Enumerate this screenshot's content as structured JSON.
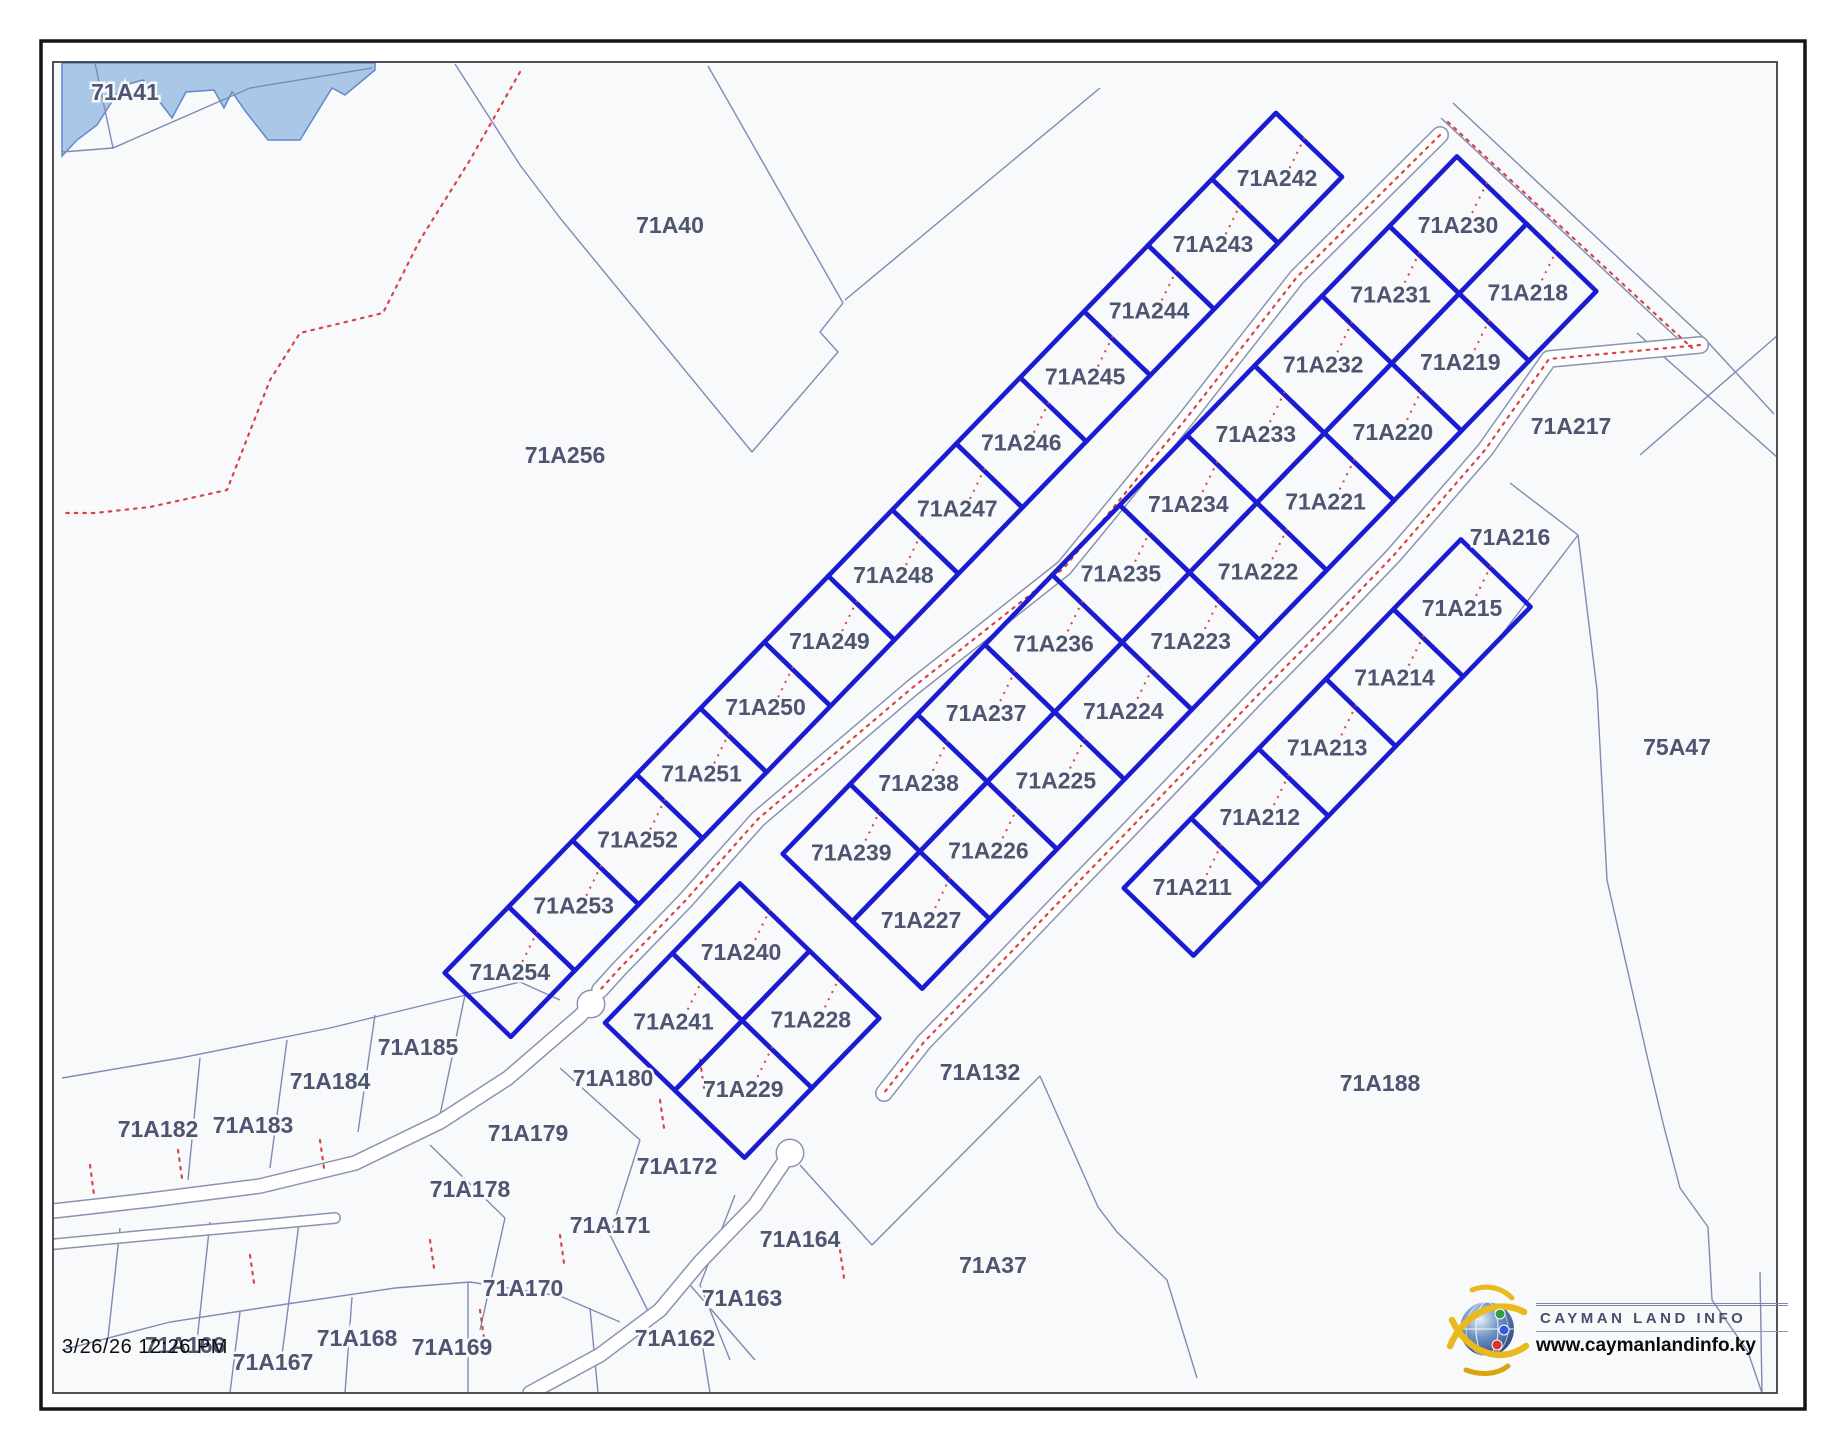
{
  "timestamp": "3/26/26 12:26 PM",
  "logo": {
    "brand": "CAYMAN LAND INFO",
    "url": "www.caymanlandinfo.ky"
  },
  "map": {
    "width": 1843,
    "height": 1445,
    "inner_frame": [
      53,
      62,
      1724,
      1331
    ],
    "outer_frame": [
      41,
      41,
      1764,
      1368
    ],
    "colors": {
      "bg": "#f8f9fb",
      "blue": "#1b1bd0",
      "thin": "#7f8ab5",
      "red": "#d94545",
      "water_fill": "#aac7e8",
      "water_line": "#6089cc",
      "label": "#4d5570",
      "road_casing": "#8a93b0",
      "frame_outer": "#141414",
      "frame_inner": "#3f3f44"
    },
    "u": [
      -0.695,
      0.719
    ],
    "v": [
      0.719,
      0.695
    ],
    "water": [
      [
        62,
        63
      ],
      [
        375,
        63
      ],
      [
        375,
        70
      ],
      [
        345,
        95
      ],
      [
        332,
        88
      ],
      [
        300,
        140
      ],
      [
        268,
        140
      ],
      [
        246,
        112
      ],
      [
        232,
        92
      ],
      [
        224,
        108
      ],
      [
        214,
        90
      ],
      [
        186,
        92
      ],
      [
        172,
        118
      ],
      [
        143,
        80
      ],
      [
        122,
        86
      ],
      [
        97,
        125
      ],
      [
        77,
        140
      ],
      [
        62,
        156
      ]
    ],
    "strips": [
      {
        "name": "west-strip",
        "start": [
          1277,
          178
        ],
        "step": 92,
        "hu": 46,
        "hv": 46,
        "cols": [
          [
            "71A242",
            "71A243",
            "71A244",
            "71A245",
            "71A246",
            "71A247",
            "71A248",
            "71A249",
            "71A250",
            "71A251",
            "71A252",
            "71A253",
            "71A254"
          ]
        ]
      },
      {
        "name": "main-block",
        "start": [
          1458,
          225
        ],
        "step": 97,
        "hu": 48.5,
        "hv": 48.5,
        "cols": [
          [
            "71A230",
            "71A231",
            "71A232",
            "71A233",
            "71A234",
            "71A235",
            "71A236",
            "71A237",
            "71A238",
            "71A239"
          ],
          [
            "71A218",
            "71A219",
            "71A220",
            "71A221",
            "71A222",
            "71A223",
            "71A224",
            "71A225",
            "71A226",
            "71A227"
          ]
        ]
      },
      {
        "name": "bottom-block",
        "start": [
          741,
          952
        ],
        "step": 97,
        "hu": 48.5,
        "hv": 48.5,
        "cols": [
          [
            "71A240",
            "71A241"
          ],
          [
            "71A228",
            "71A229"
          ]
        ]
      },
      {
        "name": "south-strip",
        "start": [
          1462,
          608
        ],
        "step": 97,
        "hu": 48.5,
        "hv": 48.5,
        "cols": [
          [
            "71A215",
            "71A214",
            "71A213",
            "71A212",
            "71A211"
          ]
        ]
      }
    ],
    "standalone_labels": [
      {
        "t": "71A41",
        "x": 125,
        "y": 92
      },
      {
        "t": "71A40",
        "x": 670,
        "y": 225
      },
      {
        "t": "71A256",
        "x": 565,
        "y": 455
      },
      {
        "t": "71A217",
        "x": 1571,
        "y": 426
      },
      {
        "t": "71A216",
        "x": 1510,
        "y": 537
      },
      {
        "t": "75A47",
        "x": 1677,
        "y": 747
      },
      {
        "t": "71A188",
        "x": 1380,
        "y": 1083
      },
      {
        "t": "71A132",
        "x": 980,
        "y": 1072
      },
      {
        "t": "71A37",
        "x": 993,
        "y": 1265
      },
      {
        "t": "71A185",
        "x": 418,
        "y": 1047
      },
      {
        "t": "71A184",
        "x": 330,
        "y": 1081
      },
      {
        "t": "71A183",
        "x": 253,
        "y": 1125
      },
      {
        "t": "71A182",
        "x": 158,
        "y": 1129
      },
      {
        "t": "71A180",
        "x": 613,
        "y": 1078
      },
      {
        "t": "71A179",
        "x": 528,
        "y": 1133
      },
      {
        "t": "71A178",
        "x": 470,
        "y": 1189
      },
      {
        "t": "71A172",
        "x": 677,
        "y": 1166
      },
      {
        "t": "71A171",
        "x": 610,
        "y": 1225
      },
      {
        "t": "71A170",
        "x": 523,
        "y": 1288
      },
      {
        "t": "71A164",
        "x": 800,
        "y": 1239
      },
      {
        "t": "71A163",
        "x": 742,
        "y": 1298
      },
      {
        "t": "71A162",
        "x": 675,
        "y": 1338
      },
      {
        "t": "71A166",
        "x": 185,
        "y": 1345
      },
      {
        "t": "71A167",
        "x": 273,
        "y": 1362
      },
      {
        "t": "71A168",
        "x": 357,
        "y": 1338
      },
      {
        "t": "71A169",
        "x": 452,
        "y": 1347
      }
    ],
    "thin_lines": [
      [
        [
          95,
          63
        ],
        [
          113,
          148
        ]
      ],
      [
        [
          62,
          152
        ],
        [
          113,
          148
        ],
        [
          250,
          88
        ],
        [
          372,
          68
        ]
      ],
      [
        [
          455,
          64
        ],
        [
          520,
          165
        ],
        [
          560,
          218
        ],
        [
          752,
          452
        ]
      ],
      [
        [
          708,
          66
        ],
        [
          843,
          303
        ]
      ],
      [
        [
          843,
          303
        ],
        [
          820,
          332
        ],
        [
          838,
          352
        ],
        [
          752,
          452
        ]
      ],
      [
        [
          845,
          300
        ],
        [
          1100,
          88
        ]
      ],
      [
        [
          1453,
          103
        ],
        [
          1705,
          339
        ],
        [
          1774,
          414
        ]
      ],
      [
        [
          1441,
          118
        ],
        [
          1692,
          352
        ]
      ],
      [
        [
          1640,
          455
        ],
        [
          1778,
          335
        ]
      ],
      [
        [
          1637,
          333
        ],
        [
          1778,
          458
        ]
      ],
      [
        [
          1510,
          483
        ],
        [
          1578,
          535
        ]
      ],
      [
        [
          1490,
          650
        ],
        [
          1578,
          535
        ]
      ],
      [
        [
          1578,
          535
        ],
        [
          1597,
          690
        ],
        [
          1607,
          880
        ],
        [
          1648,
          1060
        ],
        [
          1663,
          1123
        ],
        [
          1680,
          1188
        ],
        [
          1708,
          1227
        ],
        [
          1712,
          1300
        ],
        [
          1748,
          1352
        ],
        [
          1762,
          1393
        ]
      ],
      [
        [
          800,
          1165
        ],
        [
          872,
          1245
        ],
        [
          1040,
          1076
        ]
      ],
      [
        [
          1040,
          1076
        ],
        [
          1098,
          1207
        ],
        [
          1117,
          1232
        ],
        [
          1167,
          1280
        ],
        [
          1197,
          1378
        ]
      ],
      [
        [
          62,
          1078
        ],
        [
          180,
          1058
        ],
        [
          330,
          1028
        ],
        [
          445,
          1000
        ],
        [
          520,
          982
        ],
        [
          560,
          1000
        ]
      ],
      [
        [
          200,
          1058
        ],
        [
          188,
          1180
        ]
      ],
      [
        [
          287,
          1040
        ],
        [
          270,
          1168
        ]
      ],
      [
        [
          375,
          1015
        ],
        [
          358,
          1132
        ]
      ],
      [
        [
          465,
          995
        ],
        [
          440,
          1115
        ]
      ],
      [
        [
          120,
          1228
        ],
        [
          108,
          1338
        ]
      ],
      [
        [
          210,
          1222
        ],
        [
          196,
          1350
        ]
      ],
      [
        [
          300,
          1215
        ],
        [
          282,
          1355
        ]
      ],
      [
        [
          430,
          1145
        ],
        [
          505,
          1218
        ]
      ],
      [
        [
          505,
          1218
        ],
        [
          480,
          1330
        ]
      ],
      [
        [
          560,
          1068
        ],
        [
          640,
          1140
        ]
      ],
      [
        [
          640,
          1140
        ],
        [
          610,
          1235
        ],
        [
          650,
          1315
        ]
      ],
      [
        [
          735,
          1195
        ],
        [
          700,
          1285
        ],
        [
          730,
          1360
        ]
      ],
      [
        [
          62,
          1350
        ],
        [
          170,
          1322
        ],
        [
          280,
          1305
        ],
        [
          395,
          1288
        ],
        [
          470,
          1282
        ],
        [
          560,
          1296
        ],
        [
          620,
          1322
        ]
      ],
      [
        [
          240,
          1312
        ],
        [
          230,
          1393
        ]
      ],
      [
        [
          352,
          1297
        ],
        [
          345,
          1393
        ]
      ],
      [
        [
          468,
          1283
        ],
        [
          468,
          1393
        ]
      ],
      [
        [
          590,
          1308
        ],
        [
          598,
          1393
        ]
      ],
      [
        [
          700,
          1330
        ],
        [
          710,
          1393
        ]
      ],
      [
        [
          690,
          1285
        ],
        [
          755,
          1360
        ]
      ],
      [
        [
          1760,
          1272
        ],
        [
          1762,
          1393
        ]
      ]
    ],
    "roads": [
      {
        "name": "subdivision-road-a",
        "w": 15,
        "pts": [
          [
            1440,
            135
          ],
          [
            1297,
            277
          ],
          [
            1185,
            420
          ],
          [
            1064,
            568
          ],
          [
            912,
            688
          ],
          [
            758,
            819
          ],
          [
            685,
            901
          ],
          [
            620,
            968
          ],
          [
            600,
            990
          ]
        ]
      },
      {
        "name": "subdivision-road-b",
        "w": 15,
        "pts": [
          [
            1700,
            345
          ],
          [
            1549,
            359
          ],
          [
            1485,
            450
          ],
          [
            1394,
            555
          ],
          [
            1327,
            625
          ],
          [
            1259,
            694
          ],
          [
            1192,
            764
          ],
          [
            1125,
            834
          ],
          [
            1058,
            903
          ],
          [
            991,
            973
          ],
          [
            924,
            1042
          ],
          [
            884,
            1093
          ]
        ]
      },
      {
        "name": "west-access-road",
        "w": 13,
        "pts": [
          [
            45,
            1212
          ],
          [
            150,
            1200
          ],
          [
            260,
            1186
          ],
          [
            355,
            1163
          ],
          [
            440,
            1122
          ],
          [
            508,
            1078
          ],
          [
            552,
            1040
          ],
          [
            580,
            1016
          ],
          [
            591,
            1004
          ]
        ]
      },
      {
        "name": "west-access-road-2",
        "w": 9,
        "pts": [
          [
            45,
            1245
          ],
          [
            150,
            1235
          ],
          [
            250,
            1226
          ],
          [
            335,
            1218
          ]
        ]
      },
      {
        "name": "south-road",
        "w": 13,
        "pts": [
          [
            790,
            1153
          ],
          [
            755,
            1205
          ],
          [
            700,
            1262
          ],
          [
            660,
            1310
          ],
          [
            600,
            1355
          ],
          [
            530,
            1393
          ]
        ]
      }
    ],
    "culdesacs": [
      {
        "c": [
          591,
          1004
        ],
        "r": 13
      },
      {
        "c": [
          790,
          1153
        ],
        "r": 13
      }
    ],
    "red_dotted": [
      [
        [
          1440,
          135
        ],
        [
          1297,
          277
        ],
        [
          1185,
          420
        ],
        [
          1064,
          568
        ],
        [
          912,
          688
        ],
        [
          758,
          819
        ],
        [
          685,
          901
        ],
        [
          620,
          968
        ],
        [
          600,
          990
        ]
      ],
      [
        [
          1700,
          345
        ],
        [
          1549,
          359
        ],
        [
          1485,
          450
        ],
        [
          1394,
          555
        ],
        [
          1327,
          625
        ],
        [
          1259,
          694
        ],
        [
          1192,
          764
        ],
        [
          1125,
          834
        ],
        [
          1058,
          903
        ],
        [
          991,
          973
        ],
        [
          924,
          1042
        ],
        [
          884,
          1093
        ]
      ],
      [
        [
          1448,
          122
        ],
        [
          1692,
          348
        ]
      ],
      [
        [
          520,
          72
        ],
        [
          470,
          160
        ],
        [
          420,
          240
        ],
        [
          383,
          313
        ],
        [
          300,
          333
        ],
        [
          270,
          380
        ],
        [
          227,
          490
        ],
        [
          150,
          507
        ],
        [
          95,
          513
        ],
        [
          64,
          513
        ]
      ],
      [
        [
          90,
          1165
        ],
        [
          94,
          1195
        ]
      ],
      [
        [
          178,
          1150
        ],
        [
          182,
          1178
        ]
      ],
      [
        [
          320,
          1140
        ],
        [
          324,
          1168
        ]
      ],
      [
        [
          430,
          1240
        ],
        [
          434,
          1268
        ]
      ],
      [
        [
          560,
          1235
        ],
        [
          564,
          1263
        ]
      ],
      [
        [
          250,
          1255
        ],
        [
          254,
          1283
        ]
      ],
      [
        [
          660,
          1100
        ],
        [
          664,
          1128
        ]
      ],
      [
        [
          700,
          1060
        ],
        [
          704,
          1088
        ]
      ],
      [
        [
          480,
          1310
        ],
        [
          484,
          1338
        ]
      ],
      [
        [
          840,
          1250
        ],
        [
          844,
          1278
        ]
      ]
    ]
  }
}
